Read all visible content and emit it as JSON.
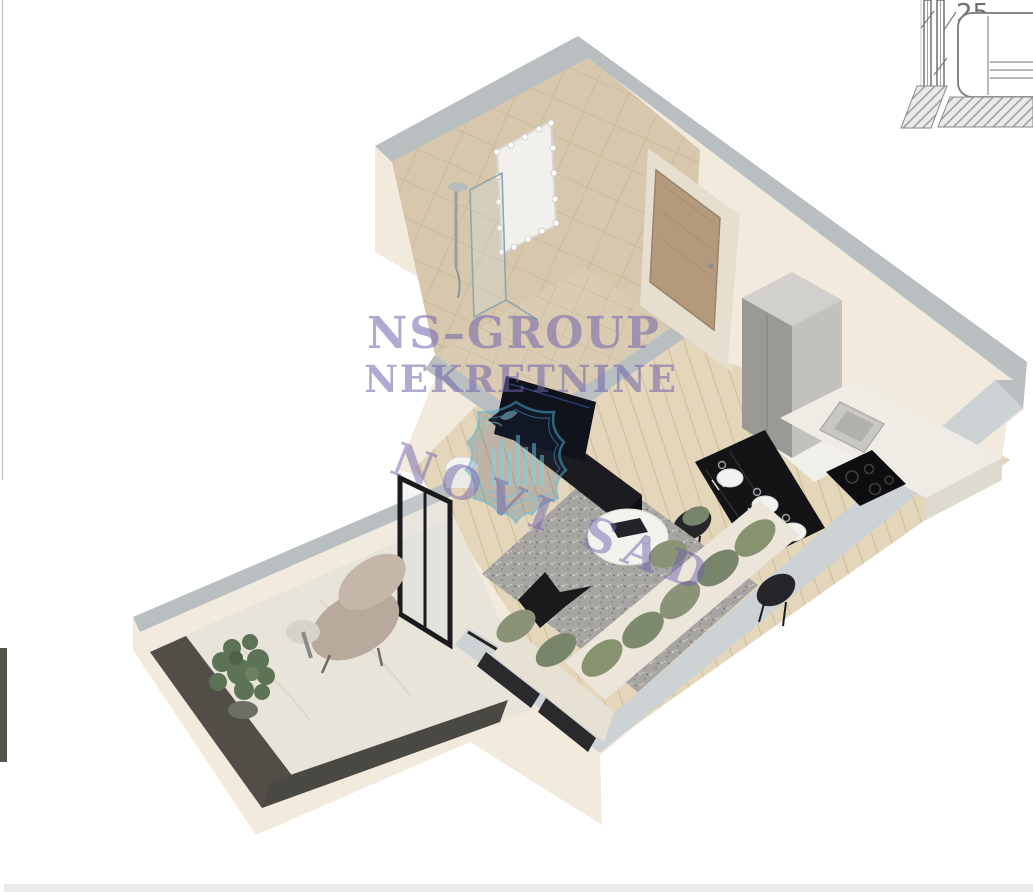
{
  "watermark": {
    "line1": "NS–GROUP",
    "line2": "NEKRETNINE",
    "city": "NOVI SAD",
    "text_color": "#6f63ab",
    "shield_outline_color": "#49a9cc"
  },
  "technical_drawing": {
    "dimension_label": "25",
    "line_color": "#7a7a7a"
  },
  "render": {
    "colors": {
      "background": "#ffffff",
      "wall_face": "#f1eadd",
      "wall_face_shadow": "#e6decf",
      "wall_top": "#b9bfc1",
      "wall_top_light": "#cdd2d4",
      "bathroom_tile": "#d7c8ad",
      "wood_floor": "#e4d6ba",
      "terrace_floor": "#e9e4da",
      "terrace_railing": "#504e46",
      "kitchen_cabinet": "#c3c1bd",
      "counter": "#efece6",
      "cooktop": "#0e0e10",
      "dining_table": "#141416",
      "chair": "#26262a",
      "tv_unit": "#1c1c20",
      "tv_screen": "#10131c",
      "sofa": "#ece6da",
      "cushion": "#8b9377",
      "rug": "#a7a5a2",
      "door_wood": "#b49a7d",
      "mirror": "#f2f0ec",
      "plant": "#5d7355",
      "page_border": "#c9c9c9",
      "bottom_band": "#ebebeb",
      "side_fragment": "#57544a"
    }
  }
}
